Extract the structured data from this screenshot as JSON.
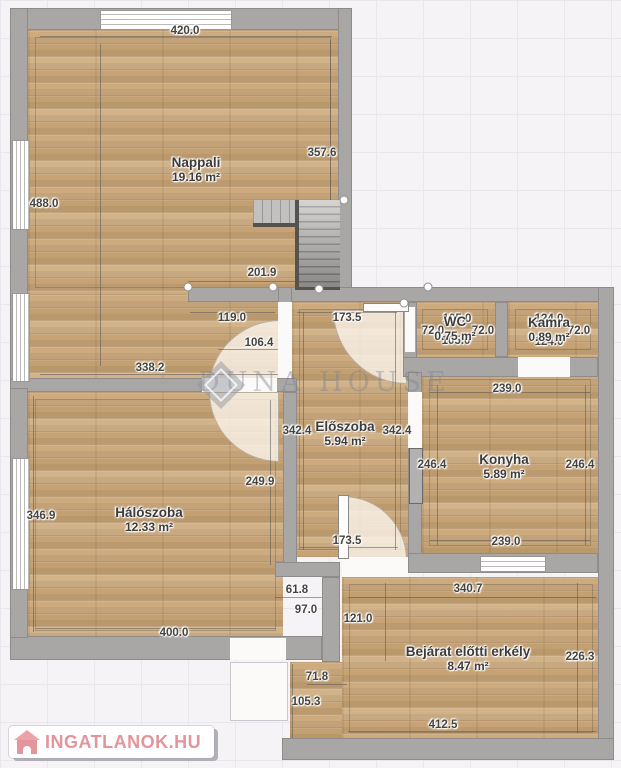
{
  "floorplan": {
    "rooms": [
      {
        "name": "Nappali",
        "area": "19.16 m²",
        "x": 196,
        "y": 170
      },
      {
        "name": "Hálószoba",
        "area": "12.33 m²",
        "x": 149,
        "y": 520
      },
      {
        "name": "Előszoba",
        "area": "5.94 m²",
        "x": 345,
        "y": 434
      },
      {
        "name": "Konyha",
        "area": "5.89 m²",
        "x": 504,
        "y": 467
      },
      {
        "name": "WC",
        "area": "0.75 m²",
        "x": 455,
        "y": 329
      },
      {
        "name": "Kamra",
        "area": "0.89 m²",
        "x": 549,
        "y": 330
      },
      {
        "name": "Bejárat előtti erkély",
        "area": "8.47 m²",
        "x": 468,
        "y": 659
      }
    ],
    "dimension_labels": [
      {
        "text": "420.0",
        "x": 185,
        "y": 31
      },
      {
        "text": "488.0",
        "x": 44,
        "y": 204
      },
      {
        "text": "357.6",
        "x": 322,
        "y": 153
      },
      {
        "text": "201.9",
        "x": 262,
        "y": 273
      },
      {
        "text": "119.0",
        "x": 232,
        "y": 318
      },
      {
        "text": "106.4",
        "x": 259,
        "y": 343
      },
      {
        "text": "338.2",
        "x": 150,
        "y": 368
      },
      {
        "text": "173.5",
        "x": 347,
        "y": 318
      },
      {
        "text": "173.5",
        "x": 347,
        "y": 541
      },
      {
        "text": "105.0",
        "x": 457,
        "y": 319
      },
      {
        "text": "72.0",
        "x": 433,
        "y": 331
      },
      {
        "text": "72.0",
        "x": 483,
        "y": 331
      },
      {
        "text": "105.0",
        "x": 456,
        "y": 341
      },
      {
        "text": "124.0",
        "x": 549,
        "y": 319
      },
      {
        "text": "72.0",
        "x": 579,
        "y": 331
      },
      {
        "text": "124.0",
        "x": 549,
        "y": 342
      },
      {
        "text": "342.4",
        "x": 297,
        "y": 431
      },
      {
        "text": "342.4",
        "x": 397,
        "y": 431
      },
      {
        "text": "239.0",
        "x": 507,
        "y": 389
      },
      {
        "text": "246.4",
        "x": 432,
        "y": 465
      },
      {
        "text": "246.4",
        "x": 580,
        "y": 465
      },
      {
        "text": "239.0",
        "x": 506,
        "y": 542
      },
      {
        "text": "346.9",
        "x": 41,
        "y": 516
      },
      {
        "text": "249.9",
        "x": 260,
        "y": 482
      },
      {
        "text": "400.0",
        "x": 174,
        "y": 633
      },
      {
        "text": "61.8",
        "x": 297,
        "y": 590
      },
      {
        "text": "97.0",
        "x": 306,
        "y": 610
      },
      {
        "text": "121.0",
        "x": 358,
        "y": 619
      },
      {
        "text": "71.8",
        "x": 317,
        "y": 677
      },
      {
        "text": "105.3",
        "x": 306,
        "y": 702
      },
      {
        "text": "340.7",
        "x": 468,
        "y": 589
      },
      {
        "text": "226.3",
        "x": 580,
        "y": 657
      },
      {
        "text": "412.5",
        "x": 443,
        "y": 725
      }
    ]
  },
  "watermark": {
    "text": "DUNA HOUSE"
  },
  "logo": {
    "text": "INGATLANOK.HU"
  }
}
